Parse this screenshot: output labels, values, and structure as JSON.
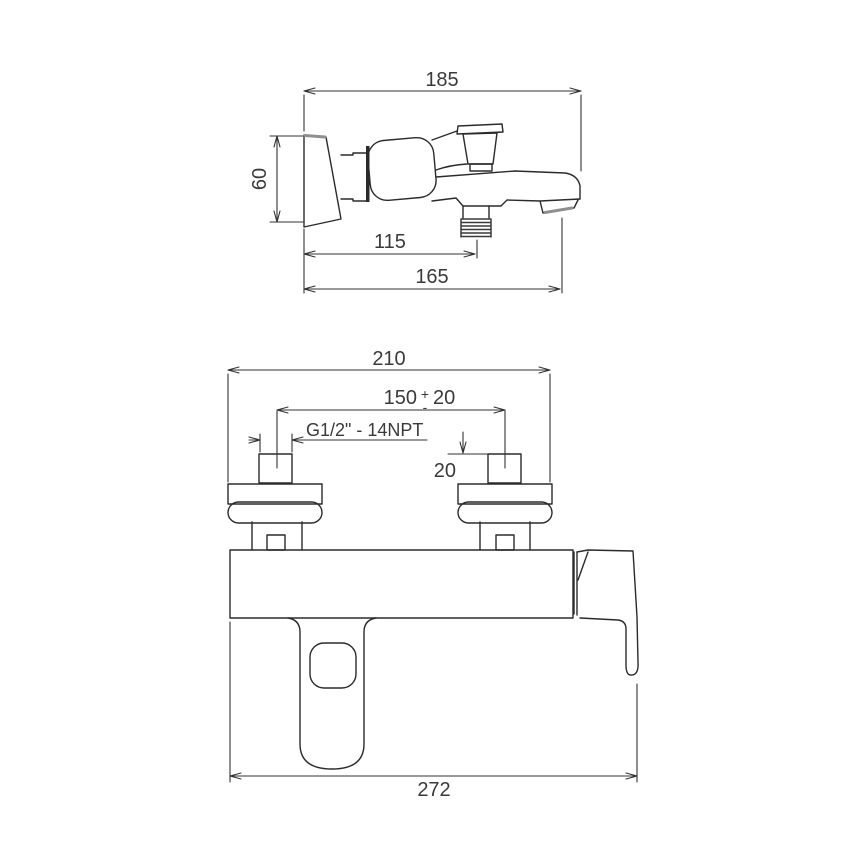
{
  "drawing": {
    "line_color": "#2b2b2b",
    "dimension_color": "#333333",
    "accent_gray": "#8f8f8f",
    "background": "#ffffff"
  },
  "side_view": {
    "dim_total_length": "185",
    "dim_height": "60",
    "dim_shower_outlet_offset": "115",
    "dim_spout_reach": "165"
  },
  "front_view": {
    "dim_total_width": "210",
    "dim_connection_spacing": "150",
    "dim_tolerance_plus": "+",
    "dim_tolerance_minus": "-",
    "dim_tolerance_value": "20",
    "thread_spec": "G1/2\" - 14NPT",
    "dim_connector_height": "20",
    "dim_overall_width_with_handle": "272"
  }
}
